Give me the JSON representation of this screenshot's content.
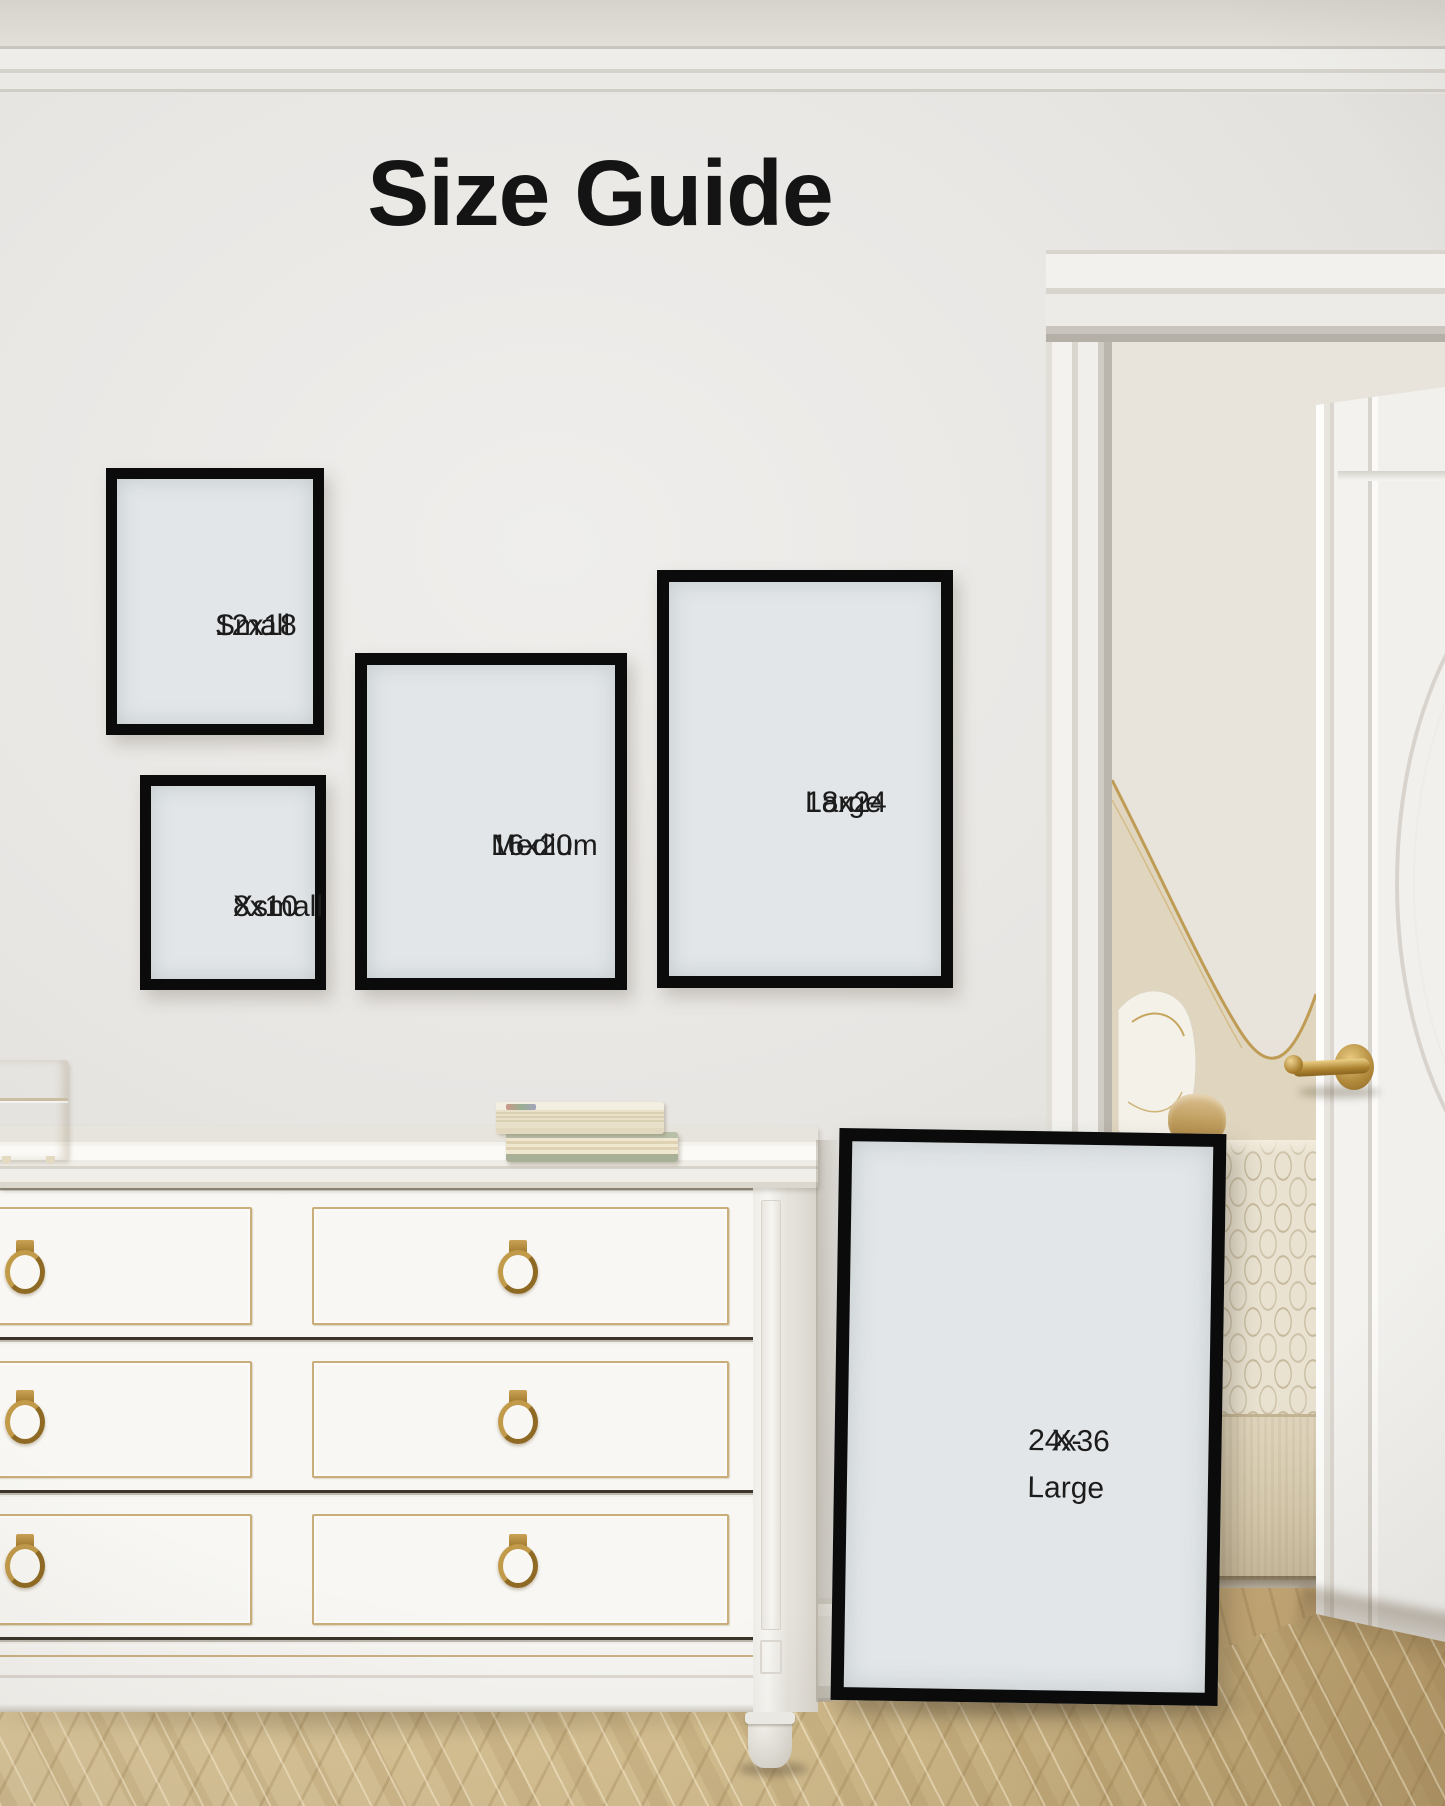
{
  "title": "Size Guide",
  "frames": [
    {
      "name": "Small",
      "dimensions": "12x18"
    },
    {
      "name": "Xsmall",
      "dimensions": "8x10"
    },
    {
      "name": "Medium",
      "dimensions": "16x20"
    },
    {
      "name": "Large",
      "dimensions": "18x24"
    },
    {
      "name": "X-Large",
      "dimensions": "24x36"
    }
  ],
  "colors": {
    "frame_border": "#0b0b0b",
    "frame_mat": "#e2e6e8",
    "wall": "#e8e6e3",
    "floor_wood": "#d7c092",
    "brass": "#a8802f",
    "label_text": "#1c1c1c"
  }
}
